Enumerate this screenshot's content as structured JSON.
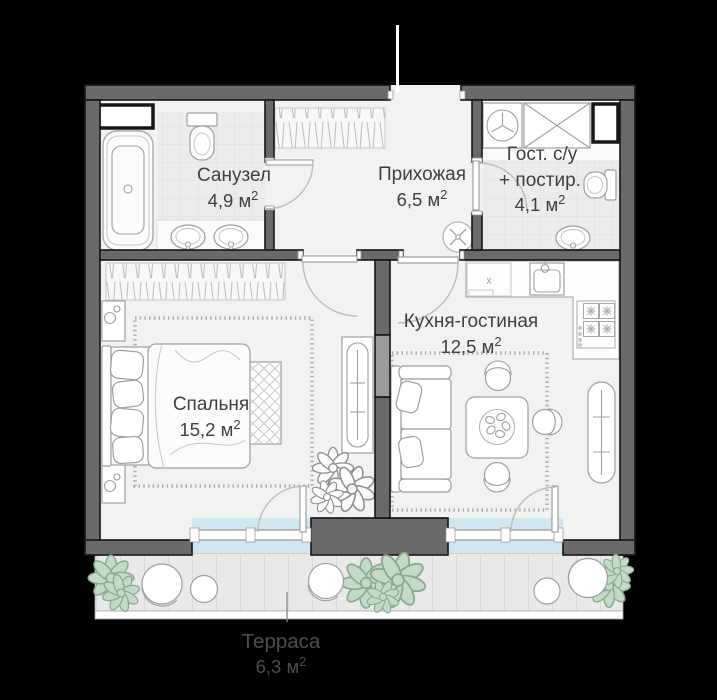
{
  "palette": {
    "background": "#000000",
    "wall": "#6a6a6a",
    "wall_light": "#9b9b9b",
    "floor": "#f2f2f2",
    "tile": "#ececec",
    "glass": "#cfe7f1",
    "deck": "#e9e9e9",
    "plant_fill": "#c3dbc6",
    "plant_stroke": "#88aa8e",
    "label": "#3f3f3f",
    "terrace_label": "#4d4d4d"
  },
  "rooms": {
    "bathroom": {
      "name": "Санузел",
      "area": "4,9 м",
      "area_sup": "2"
    },
    "hallway": {
      "name": "Прихожая",
      "area": "6,5 м",
      "area_sup": "2"
    },
    "guest_wc": {
      "name_line1": "Гост. с/у",
      "name_line2": "+ постир.",
      "area": "4,1 м",
      "area_sup": "2"
    },
    "kitchen_living": {
      "name": "Кухня-гостиная",
      "area": "12,5 м",
      "area_sup": "2"
    },
    "bedroom": {
      "name": "Спальня",
      "area": "15,2 м",
      "area_sup": "2"
    },
    "terrace": {
      "name": "Терраса",
      "area": "6,3 м",
      "area_sup": "2"
    }
  },
  "markers": {
    "kitchen_cabinet_mark": "х"
  }
}
